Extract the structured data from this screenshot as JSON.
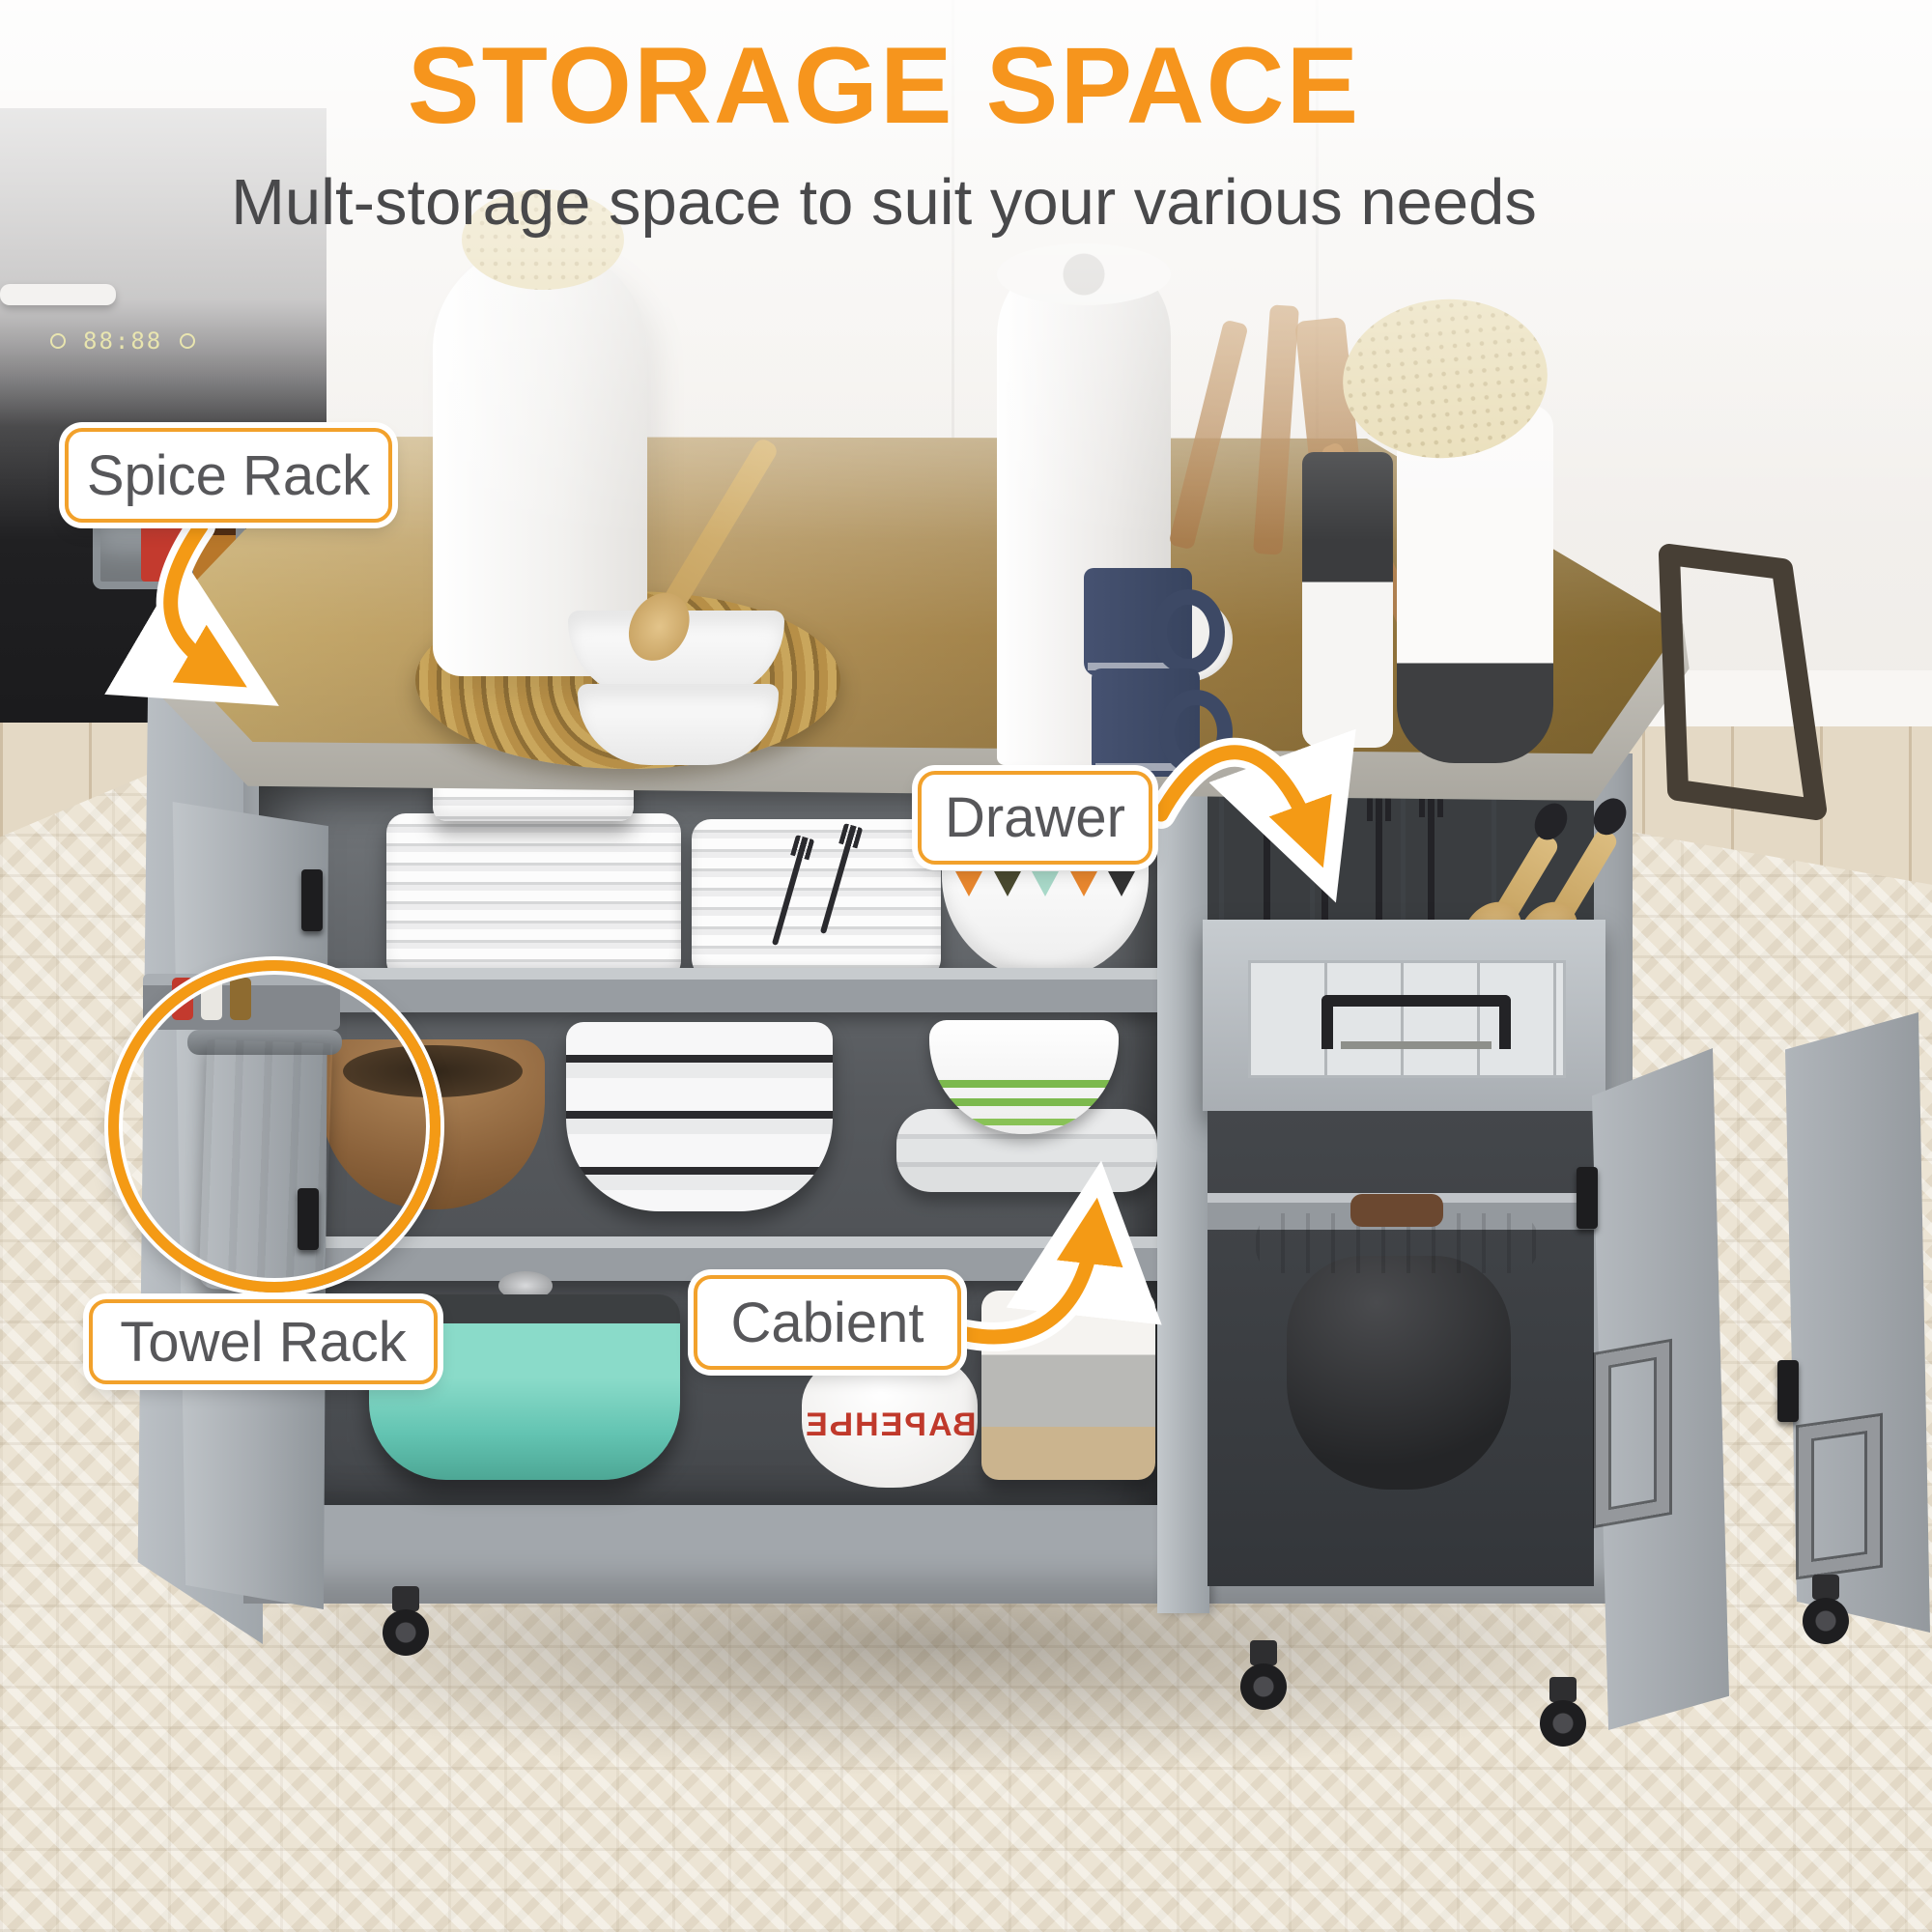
{
  "page": {
    "title": "STORAGE SPACE",
    "subtitle": "Mult-storage space to suit your various needs"
  },
  "callouts": {
    "spice_rack": {
      "label": "Spice Rack"
    },
    "drawer": {
      "label": "Drawer"
    },
    "towel_rack": {
      "label": "Towel Rack"
    },
    "cabinet": {
      "label": "Cabient"
    }
  },
  "oven": {
    "display": "88:88"
  },
  "jar": {
    "mirrored_text": "ВАРЕНЬЕ"
  },
  "colors": {
    "title_orange": "#F6951D",
    "accent_orange": "#F49A15",
    "label_text": "#57575A",
    "cabinet_gray": "#A2A7AC",
    "interior_gray": "#55585C",
    "countertop_tan": "#B3935A",
    "rug_cream": "#ECE4D4",
    "teal_pot": "#6FCDBA"
  }
}
